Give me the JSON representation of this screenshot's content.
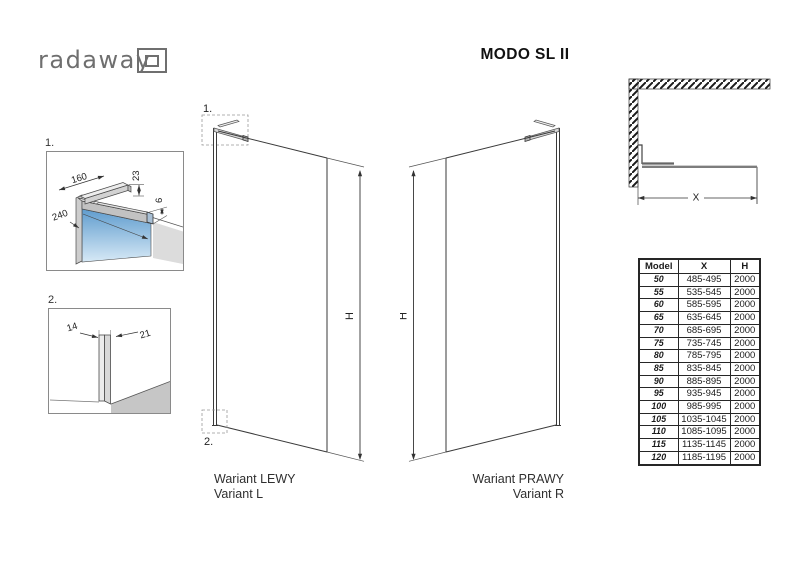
{
  "logo": {
    "text": "radaway"
  },
  "title": "MODO SL II",
  "detail1": {
    "label": "1.",
    "dim_length": "160",
    "dim_height": "23",
    "dim_depth": "240",
    "dim_clamp": "6"
  },
  "detail2": {
    "label": "2.",
    "dim_left": "14",
    "dim_right": "21"
  },
  "left_variant": {
    "callout_top": "1.",
    "callout_bottom": "2.",
    "height_label": "H",
    "caption_pl": "Wariant LEWY",
    "caption_en": "Variant L"
  },
  "right_variant": {
    "height_label": "H",
    "caption_pl": "Wariant PRAWY",
    "caption_en": "Variant R"
  },
  "top_view": {
    "width_label": "X"
  },
  "size_table": {
    "col_model": "Model",
    "col_x": "X",
    "col_h": "H",
    "rows": [
      [
        "50",
        "485-495",
        "2000"
      ],
      [
        "55",
        "535-545",
        "2000"
      ],
      [
        "60",
        "585-595",
        "2000"
      ],
      [
        "65",
        "635-645",
        "2000"
      ],
      [
        "70",
        "685-695",
        "2000"
      ],
      [
        "75",
        "735-745",
        "2000"
      ],
      [
        "80",
        "785-795",
        "2000"
      ],
      [
        "85",
        "835-845",
        "2000"
      ],
      [
        "90",
        "885-895",
        "2000"
      ],
      [
        "95",
        "935-945",
        "2000"
      ],
      [
        "100",
        "985-995",
        "2000"
      ],
      [
        "105",
        "1035-1045",
        "2000"
      ],
      [
        "110",
        "1085-1095",
        "2000"
      ],
      [
        "115",
        "1135-1145",
        "2000"
      ],
      [
        "120",
        "1185-1195",
        "2000"
      ]
    ]
  },
  "colors": {
    "glass_top": "#5f9cce",
    "glass_bottom": "#d7e9f6",
    "line": "#3a3a3a",
    "logo_gray": "#6f6f6f"
  }
}
